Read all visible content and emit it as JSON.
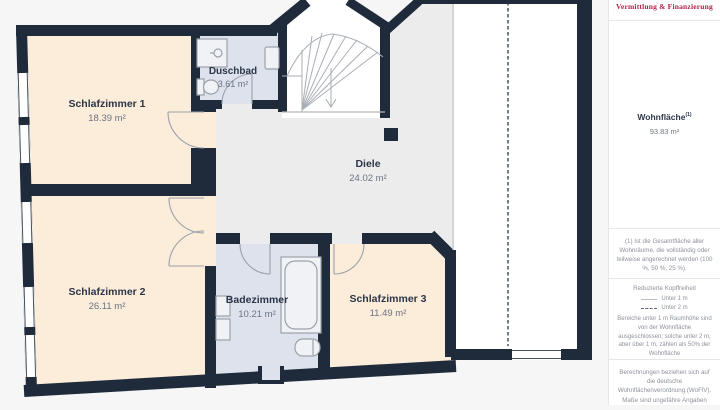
{
  "floorplan": {
    "rooms": [
      {
        "id": "schlafzimmer-1",
        "name": "Schlafzimmer 1",
        "area": "18.39 m²"
      },
      {
        "id": "schlafzimmer-2",
        "name": "Schlafzimmer 2",
        "area": "26.11 m²"
      },
      {
        "id": "duschbad",
        "name": "Duschbad",
        "area": "3.61 m²"
      },
      {
        "id": "diele",
        "name": "Diele",
        "area": "24.02 m²"
      },
      {
        "id": "badezimmer",
        "name": "Badezimmer",
        "area": "10.21 m²"
      },
      {
        "id": "schlafzimmer-3",
        "name": "Schlafzimmer 3",
        "area": "11.49 m²"
      }
    ],
    "colors": {
      "wall": "#1f2b3a",
      "room_beige": "#fcecda",
      "room_blue": "#dde2ed",
      "hall_gray": "#ececec",
      "excluded_white": "#ffffff",
      "thin_line": "#b8b8b8"
    }
  },
  "sidebar": {
    "brand_tagline": "Vermittlung & Finanzierung",
    "brand_color": "#b5204a",
    "area_label": "Wohnfläche",
    "area_superscript": "(1)",
    "area_value": "93.83 m²",
    "footnote_area": "(1) Ist die Gesamtfläche aller Wohnräume, die vollständig oder teilweise angerechnet werden (100 %, 50 %, 25 %).",
    "legend_title": "Reduzierte Kopffreiheit",
    "legend_items": [
      {
        "line": "solid",
        "label": "Unter 1 m"
      },
      {
        "line": "dashed",
        "label": "Unter 2 m"
      }
    ],
    "legend_description": "Bereiche unter 1 m Raumhöhe sind von der Wohnfläche ausgeschlossen; solche unter 2 m, aber über 1 m, zählen als 50% der Wohnfläche",
    "footnote_calc": "Berechnungen beziehen sich auf die deutsche Wohnflächenverordnung (WoFlV). Maße sind ungefähre Angaben"
  }
}
